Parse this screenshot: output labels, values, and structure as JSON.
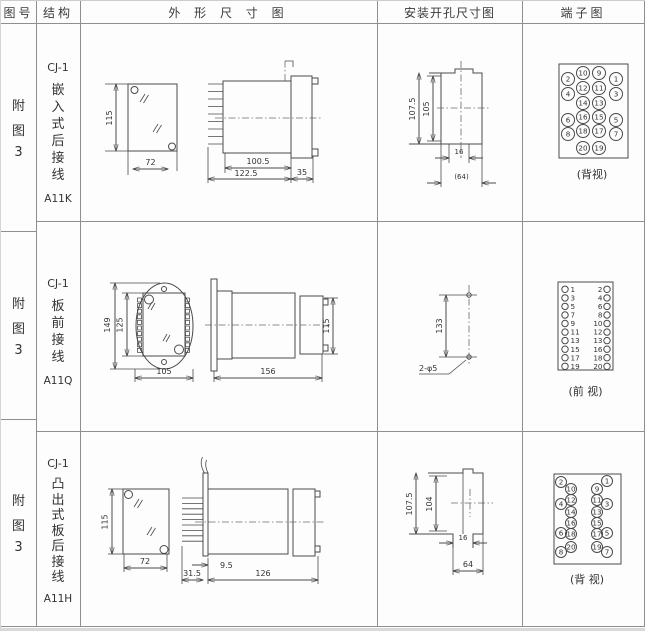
{
  "header": {
    "fig_no": "图号",
    "structure": "结构",
    "outline": "外 形 尺 寸 图",
    "mounting": "安装开孔尺寸图",
    "terminal": "端子图"
  },
  "rows": [
    {
      "fig": [
        "附",
        "图",
        "3"
      ],
      "structure": {
        "title": "CJ-1",
        "chars": [
          "嵌",
          "入",
          "式",
          "后",
          "接",
          "线"
        ],
        "model": "A11K"
      },
      "outline": {
        "height": "115",
        "width": "72",
        "len1": "100.5",
        "len2": "122.5",
        "len3": "35"
      },
      "mounting": {
        "h1": "107.5",
        "h2": "105",
        "w1": "16",
        "w2": "(64)"
      },
      "terminal": {
        "label": "(背视)",
        "outer_left": [
          "2",
          "4",
          "6",
          "8"
        ],
        "mid_left": [
          "10",
          "12",
          "14",
          "16",
          "18",
          "20"
        ],
        "mid_right": [
          "9",
          "11",
          "13",
          "15",
          "17",
          "19"
        ],
        "outer_right": [
          "1",
          "3",
          "5",
          "7"
        ]
      }
    },
    {
      "fig": [
        "附",
        "图",
        "3"
      ],
      "structure": {
        "title": "CJ-1",
        "chars": [
          "板",
          "前",
          "接",
          "线"
        ],
        "model": "A11Q"
      },
      "outline": {
        "h1": "149",
        "h2": "125",
        "w1": "105",
        "len": "156",
        "h3": "115"
      },
      "mounting": {
        "spacing": "133",
        "holes": "2-φ5"
      },
      "terminal": {
        "label": "(前 视)",
        "left": [
          "1",
          "3",
          "5",
          "7",
          "9",
          "11",
          "13",
          "15",
          "17",
          "19"
        ],
        "right": [
          "2",
          "4",
          "6",
          "8",
          "10",
          "12",
          "13",
          "16",
          "18",
          "20"
        ]
      }
    },
    {
      "fig": [
        "附",
        "图",
        "3"
      ],
      "structure": {
        "title": "CJ-1",
        "chars": [
          "凸",
          "出",
          "式",
          "板",
          "后",
          "接",
          "线"
        ],
        "model": "A11H"
      },
      "outline": {
        "height": "115",
        "width": "72",
        "plate": "31.5",
        "gap": "9.5",
        "len": "126"
      },
      "mounting": {
        "h1": "107.5",
        "h2": "104",
        "w1": "16",
        "w2": "64"
      },
      "terminal": {
        "label": "(背 视)",
        "outer_left": [
          "2",
          "4",
          "6",
          "8"
        ],
        "inner_left": [
          "10",
          "12",
          "14",
          "16",
          "18",
          "20"
        ],
        "inner_right": [
          "9",
          "11",
          "13",
          "15",
          "17",
          "19"
        ],
        "outer_right": [
          "1",
          "3",
          "5",
          "7"
        ]
      }
    }
  ]
}
